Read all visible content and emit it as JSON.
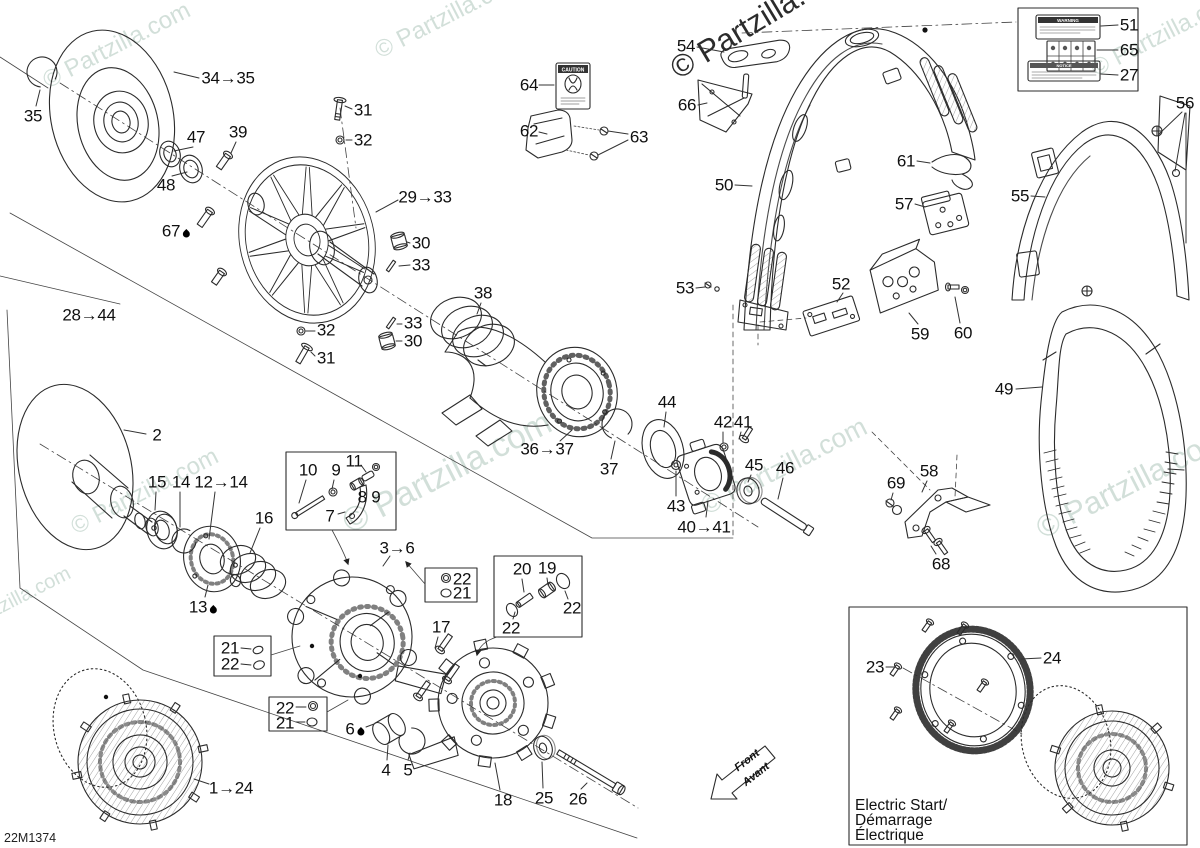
{
  "diagram": {
    "code": "22M1374",
    "watermark_text": "© Partzilla.com",
    "front": {
      "line1": "Front",
      "line2": "Avant"
    },
    "electric_box": {
      "line1": "Electric Start/",
      "line2": "Démarrage",
      "line3": "Électrique"
    },
    "stickers": {
      "caution": "CAUTION",
      "warning": "WARNING",
      "notice": "NOTICE"
    },
    "callouts": [
      {
        "label": "35",
        "x": 33,
        "y": 116,
        "l": [
          [
            36,
            106,
            40,
            90
          ]
        ]
      },
      {
        "label": "34→35",
        "x": 228,
        "y": 78,
        "l": [
          [
            199,
            78,
            174,
            72
          ]
        ]
      },
      {
        "label": "47",
        "x": 196,
        "y": 137,
        "l": [
          [
            193,
            147,
            174,
            151
          ]
        ]
      },
      {
        "label": "48",
        "x": 166,
        "y": 185,
        "l": [
          [
            172,
            176,
            187,
            172
          ]
        ]
      },
      {
        "label": "39",
        "x": 238,
        "y": 132,
        "l": [
          [
            236,
            142,
            231,
            153
          ]
        ]
      },
      {
        "label": "31",
        "x": 363,
        "y": 110,
        "l": [
          [
            352,
            109,
            345,
            106
          ]
        ]
      },
      {
        "label": "32",
        "x": 363,
        "y": 140,
        "l": [
          [
            352,
            140,
            346,
            140
          ]
        ]
      },
      {
        "label": "29→33",
        "x": 425,
        "y": 197,
        "l": [
          [
            398,
            200,
            376,
            212
          ]
        ]
      },
      {
        "label": "67",
        "drop": true,
        "x": 176,
        "y": 231
      },
      {
        "label": "30",
        "x": 421,
        "y": 243,
        "l": [
          [
            410,
            243,
            407,
            242
          ]
        ]
      },
      {
        "label": "33",
        "x": 421,
        "y": 265,
        "l": [
          [
            410,
            265,
            399,
            266
          ]
        ]
      },
      {
        "label": "28→44",
        "x": 89,
        "y": 315
      },
      {
        "label": "32",
        "x": 326,
        "y": 330,
        "l": [
          [
            315,
            331,
            306,
            331
          ]
        ]
      },
      {
        "label": "33",
        "x": 413,
        "y": 323,
        "l": [
          [
            402,
            324,
            397,
            324
          ]
        ]
      },
      {
        "label": "30",
        "x": 413,
        "y": 341,
        "l": [
          [
            402,
            341,
            396,
            341
          ]
        ]
      },
      {
        "label": "31",
        "x": 326,
        "y": 358,
        "l": [
          [
            315,
            356,
            311,
            352
          ]
        ]
      },
      {
        "label": "38",
        "x": 483,
        "y": 293,
        "l": [
          [
            481,
            303,
            477,
            314
          ]
        ]
      },
      {
        "label": "64",
        "x": 529,
        "y": 85,
        "l": [
          [
            539,
            85,
            554,
            85
          ]
        ]
      },
      {
        "label": "62",
        "x": 529,
        "y": 131,
        "l": [
          [
            539,
            132,
            547,
            134
          ]
        ]
      },
      {
        "label": "63",
        "x": 639,
        "y": 137,
        "l": [
          [
            628,
            134,
            608,
            131
          ],
          [
            628,
            140,
            598,
            155
          ]
        ]
      },
      {
        "label": "54",
        "x": 686,
        "y": 46,
        "l": [
          [
            697,
            47,
            724,
            52
          ]
        ]
      },
      {
        "label": "66",
        "x": 687,
        "y": 105,
        "l": [
          [
            698,
            105,
            707,
            103
          ]
        ]
      },
      {
        "label": "50",
        "x": 724,
        "y": 185,
        "l": [
          [
            735,
            185,
            752,
            186
          ]
        ]
      },
      {
        "label": "53",
        "x": 685,
        "y": 288,
        "l": [
          [
            696,
            288,
            705,
            287
          ]
        ]
      },
      {
        "label": "36→37",
        "x": 547,
        "y": 449,
        "l": [
          [
            560,
            441,
            572,
            430
          ]
        ]
      },
      {
        "label": "37",
        "x": 609,
        "y": 469,
        "l": [
          [
            611,
            459,
            615,
            441
          ]
        ]
      },
      {
        "label": "44",
        "x": 667,
        "y": 402,
        "l": [
          [
            666,
            412,
            664,
            427
          ]
        ]
      },
      {
        "label": "42",
        "x": 723,
        "y": 422,
        "l": [
          [
            723,
            432,
            723,
            443
          ]
        ]
      },
      {
        "label": "41",
        "x": 743,
        "y": 422,
        "l": [
          [
            741,
            432,
            739,
            439
          ]
        ]
      },
      {
        "label": "43",
        "x": 676,
        "y": 506,
        "l": [
          [
            676,
            496,
            676,
            471
          ]
        ]
      },
      {
        "label": "40→41",
        "x": 704,
        "y": 527,
        "l": [
          [
            706,
            517,
            708,
            501
          ]
        ]
      },
      {
        "label": "45",
        "x": 754,
        "y": 465,
        "l": [
          [
            751,
            475,
            748,
            482
          ]
        ]
      },
      {
        "label": "46",
        "x": 785,
        "y": 468,
        "l": [
          [
            783,
            478,
            778,
            499
          ]
        ]
      },
      {
        "label": "51",
        "x": 1129,
        "y": 25,
        "l": [
          [
            1118,
            25,
            1101,
            26
          ]
        ]
      },
      {
        "label": "65",
        "x": 1129,
        "y": 50,
        "l": [
          [
            1118,
            50,
            1097,
            50
          ]
        ]
      },
      {
        "label": "27",
        "x": 1129,
        "y": 75,
        "l": [
          [
            1118,
            75,
            1101,
            74
          ]
        ]
      },
      {
        "label": "56",
        "x": 1185,
        "y": 103,
        "l": [
          [
            1182,
            112,
            1159,
            134
          ],
          [
            1185,
            113,
            1175,
            171
          ],
          [
            1186,
            113,
            1186,
            243
          ]
        ]
      },
      {
        "label": "61",
        "x": 906,
        "y": 161,
        "l": [
          [
            917,
            161,
            930,
            163
          ]
        ]
      },
      {
        "label": "57",
        "x": 904,
        "y": 204,
        "l": [
          [
            915,
            204,
            925,
            207
          ]
        ]
      },
      {
        "label": "55",
        "x": 1020,
        "y": 196,
        "l": [
          [
            1031,
            196,
            1045,
            197
          ]
        ]
      },
      {
        "label": "52",
        "x": 841,
        "y": 284,
        "l": [
          [
            843,
            293,
            837,
            302
          ]
        ]
      },
      {
        "label": "59",
        "x": 920,
        "y": 334,
        "l": [
          [
            918,
            324,
            909,
            313
          ]
        ]
      },
      {
        "label": "60",
        "x": 963,
        "y": 333,
        "l": [
          [
            960,
            323,
            955,
            297
          ]
        ]
      },
      {
        "label": "49",
        "x": 1004,
        "y": 389,
        "l": [
          [
            1016,
            389,
            1042,
            387
          ]
        ]
      },
      {
        "label": "58",
        "x": 929,
        "y": 471,
        "l": [
          [
            927,
            481,
            922,
            492
          ]
        ]
      },
      {
        "label": "69",
        "x": 896,
        "y": 483,
        "l": [
          [
            893,
            493,
            891,
            500
          ]
        ]
      },
      {
        "label": "68",
        "x": 941,
        "y": 564,
        "l": [
          [
            936,
            554,
            931,
            546
          ]
        ]
      },
      {
        "label": "2",
        "x": 157,
        "y": 435,
        "l": [
          [
            146,
            434,
            124,
            430
          ]
        ]
      },
      {
        "label": "15",
        "x": 157,
        "y": 482,
        "l": [
          [
            156,
            492,
            155,
            510
          ]
        ]
      },
      {
        "label": "14",
        "x": 181,
        "y": 482,
        "l": [
          [
            180,
            492,
            180,
            527
          ]
        ]
      },
      {
        "label": "12→14",
        "x": 221,
        "y": 482,
        "l": [
          [
            215,
            492,
            209,
            539
          ]
        ]
      },
      {
        "label": "16",
        "x": 264,
        "y": 518,
        "l": [
          [
            260,
            528,
            250,
            553
          ]
        ]
      },
      {
        "label": "10",
        "x": 308,
        "y": 470,
        "l": [
          [
            306,
            480,
            299,
            503
          ]
        ]
      },
      {
        "label": "9",
        "x": 336,
        "y": 470,
        "l": [
          [
            334,
            480,
            332,
            489
          ]
        ]
      },
      {
        "label": "11",
        "x": 354,
        "y": 461,
        "l": [
          [
            361,
            465,
            366,
            472
          ]
        ]
      },
      {
        "label": "8 9",
        "x": 369,
        "y": 497
      },
      {
        "label": "7",
        "x": 330,
        "y": 516,
        "l": [
          [
            338,
            514,
            345,
            512
          ]
        ]
      },
      {
        "label": "3→6",
        "x": 397,
        "y": 548,
        "l": [
          [
            390,
            556,
            383,
            566
          ]
        ]
      },
      {
        "label": "22",
        "x": 462,
        "y": 579
      },
      {
        "label": "21",
        "x": 462,
        "y": 593
      },
      {
        "label": "17",
        "x": 441,
        "y": 627,
        "l": [
          [
            438,
            637,
            435,
            648
          ]
        ]
      },
      {
        "label": "20",
        "x": 522,
        "y": 569,
        "l": [
          [
            522,
            579,
            524,
            592
          ]
        ]
      },
      {
        "label": "19",
        "x": 547,
        "y": 568,
        "l": [
          [
            547,
            578,
            548,
            585
          ]
        ]
      },
      {
        "label": "22",
        "x": 572,
        "y": 608,
        "l": [
          [
            568,
            599,
            565,
            591
          ]
        ]
      },
      {
        "label": "22",
        "x": 511,
        "y": 628,
        "l": [
          [
            513,
            619,
            515,
            612
          ]
        ]
      },
      {
        "label": "13",
        "drop": true,
        "x": 203,
        "y": 607,
        "l": [
          [
            205,
            597,
            208,
            585
          ]
        ]
      },
      {
        "label": "21",
        "x": 230,
        "y": 648
      },
      {
        "label": "22",
        "x": 230,
        "y": 664
      },
      {
        "label": "22",
        "x": 285,
        "y": 708
      },
      {
        "label": "21",
        "x": 285,
        "y": 723
      },
      {
        "label": "6",
        "drop": true,
        "x": 355,
        "y": 729,
        "l": [
          [
            366,
            727,
            374,
            724
          ]
        ]
      },
      {
        "label": "4",
        "x": 386,
        "y": 770,
        "l": [
          [
            387,
            760,
            388,
            745
          ]
        ]
      },
      {
        "label": "5",
        "x": 408,
        "y": 770,
        "l": [
          [
            408,
            760,
            410,
            753
          ]
        ]
      },
      {
        "label": "18",
        "x": 503,
        "y": 800,
        "l": [
          [
            500,
            790,
            495,
            763
          ]
        ]
      },
      {
        "label": "25",
        "x": 544,
        "y": 798,
        "l": [
          [
            543,
            788,
            542,
            762
          ]
        ]
      },
      {
        "label": "26",
        "x": 578,
        "y": 799,
        "l": [
          [
            581,
            789,
            587,
            783
          ]
        ]
      },
      {
        "label": "1→24",
        "x": 231,
        "y": 788,
        "l": [
          [
            209,
            784,
            194,
            779
          ]
        ]
      },
      {
        "label": "23",
        "x": 875,
        "y": 667,
        "l": [
          [
            886,
            667,
            894,
            667
          ]
        ]
      },
      {
        "label": "24",
        "x": 1052,
        "y": 658,
        "l": [
          [
            1041,
            658,
            1021,
            659
          ]
        ]
      }
    ]
  }
}
